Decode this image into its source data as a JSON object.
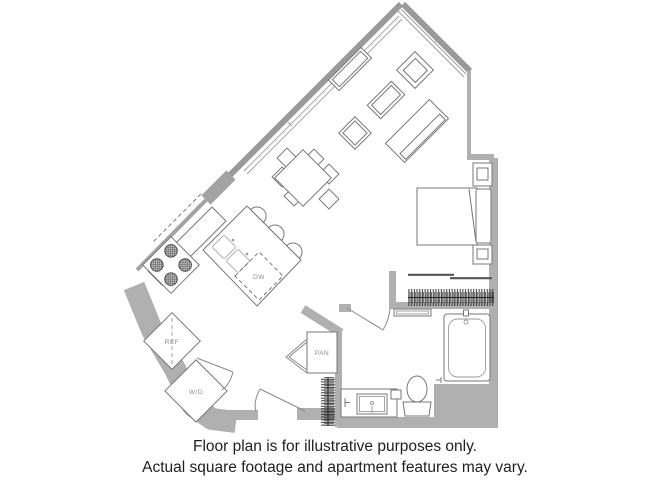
{
  "plan": {
    "labels": {
      "refrigerator": "REF",
      "washer_dryer": "W/D",
      "pantry": "PAN",
      "dishwasher": "DW"
    }
  },
  "caption": {
    "line1": "Floor plan is for illustrative purposes only.",
    "line2": "Actual square footage and apartment features may vary."
  },
  "colors": {
    "wall": "#b0b0b0",
    "wall_dark": "#9a9a9a",
    "outline": "#777777",
    "hatch": "#222222",
    "label": "#8c8c8c",
    "caption": "#1f1f1f",
    "background": "#ffffff"
  }
}
